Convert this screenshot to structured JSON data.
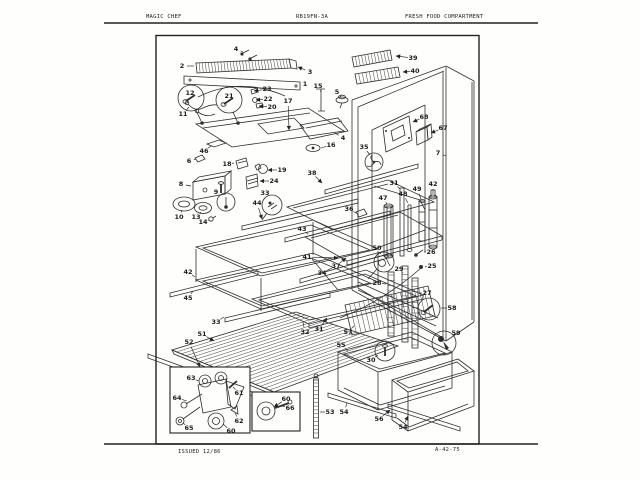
{
  "header": {
    "brand": "MAGIC CHEF",
    "model": "RB19FN-3A",
    "title": "FRESH FOOD COMPARTMENT"
  },
  "footer": {
    "issued": "ISSUED 12/86",
    "page_ref": "A-42-75"
  },
  "diagram": {
    "part_labels": [
      {
        "n": "2",
        "x": 182,
        "y": 66,
        "tx": 194,
        "ty": 66
      },
      {
        "n": "3",
        "x": 310,
        "y": 72,
        "tx": 298,
        "ty": 67
      },
      {
        "n": "1",
        "x": 305,
        "y": 84,
        "tx": 300,
        "ty": 86
      },
      {
        "n": "4",
        "x": 236,
        "y": 49,
        "tx": 243,
        "ty": 52
      },
      {
        "n": "5",
        "x": 337,
        "y": 92,
        "tx": 341,
        "ty": 97
      },
      {
        "n": "15",
        "x": 318,
        "y": 86,
        "tx": 321,
        "ty": 92
      },
      {
        "n": "17",
        "x": 288,
        "y": 101,
        "tx": 289,
        "ty": 130
      },
      {
        "n": "23",
        "x": 267,
        "y": 89,
        "tx": 254,
        "ty": 91
      },
      {
        "n": "22",
        "x": 268,
        "y": 99,
        "tx": 256,
        "ty": 100
      },
      {
        "n": "20",
        "x": 272,
        "y": 107,
        "tx": 259,
        "ty": 106
      },
      {
        "n": "12",
        "x": 190,
        "y": 93
      },
      {
        "n": "21",
        "x": 229,
        "y": 96
      },
      {
        "n": "11",
        "x": 183,
        "y": 114,
        "tx": 189,
        "ty": 107
      },
      {
        "n": "46",
        "x": 204,
        "y": 151,
        "tx": 211,
        "ty": 146
      },
      {
        "n": "6",
        "x": 189,
        "y": 161,
        "tx": 196,
        "ty": 159
      },
      {
        "n": "18",
        "x": 227,
        "y": 164,
        "tx": 234,
        "ty": 163
      },
      {
        "n": "19",
        "x": 282,
        "y": 170,
        "tx": 268,
        "ty": 170
      },
      {
        "n": "24",
        "x": 274,
        "y": 181,
        "tx": 260,
        "ty": 181
      },
      {
        "n": "8",
        "x": 181,
        "y": 184,
        "tx": 191,
        "ty": 186
      },
      {
        "n": "9",
        "x": 216,
        "y": 192,
        "tx": 221,
        "ty": 190
      },
      {
        "n": "33",
        "x": 265,
        "y": 193
      },
      {
        "n": "44",
        "x": 257,
        "y": 203,
        "tx": 262,
        "ty": 219
      },
      {
        "n": "10",
        "x": 179,
        "y": 217,
        "tx": 182,
        "ty": 210
      },
      {
        "n": "13",
        "x": 196,
        "y": 217,
        "tx": 201,
        "ty": 212
      },
      {
        "n": "14",
        "x": 203,
        "y": 222,
        "tx": 209,
        "ty": 220
      },
      {
        "n": "16",
        "x": 331,
        "y": 145,
        "tx": 321,
        "ty": 148
      },
      {
        "n": "4",
        "x": 343,
        "y": 138,
        "tx": 335,
        "ty": 133
      },
      {
        "n": "35",
        "x": 364,
        "y": 147,
        "tx": 370,
        "ty": 155
      },
      {
        "n": "38",
        "x": 312,
        "y": 173,
        "tx": 322,
        "ty": 183
      },
      {
        "n": "34",
        "x": 322,
        "y": 273,
        "tx": 332,
        "ty": 268
      },
      {
        "n": "37",
        "x": 336,
        "y": 266,
        "tx": 346,
        "ty": 258
      },
      {
        "n": "43",
        "x": 302,
        "y": 229,
        "tx": 308,
        "ty": 234
      },
      {
        "n": "41",
        "x": 307,
        "y": 257,
        "tx": 338,
        "ty": 258
      },
      {
        "n": "42",
        "x": 188,
        "y": 272,
        "tx": 195,
        "ty": 277
      },
      {
        "n": "45",
        "x": 188,
        "y": 298,
        "tx": 193,
        "ty": 291
      },
      {
        "n": "33",
        "x": 216,
        "y": 322,
        "tx": 224,
        "ty": 317
      },
      {
        "n": "32",
        "x": 305,
        "y": 332,
        "tx": 303,
        "ty": 322
      },
      {
        "n": "31",
        "x": 319,
        "y": 329,
        "tx": 327,
        "ty": 318
      },
      {
        "n": "51",
        "x": 202,
        "y": 334,
        "tx": 214,
        "ty": 341
      },
      {
        "n": "52",
        "x": 189,
        "y": 342,
        "tx": 200,
        "ty": 367
      },
      {
        "n": "53",
        "x": 330,
        "y": 412,
        "tx": 320,
        "ty": 412
      },
      {
        "n": "39",
        "x": 413,
        "y": 58,
        "tx": 396,
        "ty": 56
      },
      {
        "n": "40",
        "x": 415,
        "y": 71,
        "tx": 403,
        "ty": 72
      },
      {
        "n": "68",
        "x": 424,
        "y": 117,
        "tx": 413,
        "ty": 122
      },
      {
        "n": "67",
        "x": 443,
        "y": 128,
        "tx": 431,
        "ty": 133
      },
      {
        "n": "7",
        "x": 438,
        "y": 153,
        "tx": 446,
        "ty": 156
      },
      {
        "n": "31",
        "x": 394,
        "y": 183,
        "tx": 400,
        "ty": 189
      },
      {
        "n": "47",
        "x": 383,
        "y": 198,
        "tx": 387,
        "ty": 204
      },
      {
        "n": "48",
        "x": 403,
        "y": 194,
        "tx": 408,
        "ty": 203
      },
      {
        "n": "49",
        "x": 417,
        "y": 189,
        "tx": 421,
        "ty": 199
      },
      {
        "n": "42",
        "x": 433,
        "y": 184,
        "tx": 433,
        "ty": 194
      },
      {
        "n": "36",
        "x": 349,
        "y": 209,
        "tx": 356,
        "ty": 213
      },
      {
        "n": "26",
        "x": 431,
        "y": 252,
        "tx": 424,
        "ty": 252
      },
      {
        "n": "25",
        "x": 432,
        "y": 266,
        "tx": 425,
        "ty": 267
      },
      {
        "n": "50",
        "x": 377,
        "y": 248,
        "tx": 381,
        "ty": 254
      },
      {
        "n": "29",
        "x": 399,
        "y": 269,
        "tx": 403,
        "ty": 273
      },
      {
        "n": "28",
        "x": 377,
        "y": 283,
        "tx": 386,
        "ty": 284
      },
      {
        "n": "27",
        "x": 427,
        "y": 293,
        "tx": 419,
        "ty": 293
      },
      {
        "n": "58",
        "x": 452,
        "y": 308,
        "tx": 441,
        "ty": 308
      },
      {
        "n": "59",
        "x": 456,
        "y": 333
      },
      {
        "n": "57",
        "x": 348,
        "y": 332,
        "tx": 354,
        "ty": 326
      },
      {
        "n": "55",
        "x": 341,
        "y": 345,
        "tx": 348,
        "ty": 351
      },
      {
        "n": "30",
        "x": 371,
        "y": 360,
        "tx": 378,
        "ty": 355
      },
      {
        "n": "54",
        "x": 344,
        "y": 412,
        "tx": 347,
        "ty": 403
      },
      {
        "n": "56",
        "x": 379,
        "y": 419,
        "tx": 390,
        "ty": 410
      },
      {
        "n": "54",
        "x": 403,
        "y": 427,
        "tx": 408,
        "ty": 416
      },
      {
        "n": "63",
        "x": 191,
        "y": 378,
        "tx": 199,
        "ty": 381
      },
      {
        "n": "61",
        "x": 239,
        "y": 393,
        "tx": 233,
        "ty": 387
      },
      {
        "n": "64",
        "x": 177,
        "y": 398,
        "tx": 187,
        "ty": 401
      },
      {
        "n": "65",
        "x": 189,
        "y": 428,
        "tx": 183,
        "ty": 423
      },
      {
        "n": "62",
        "x": 239,
        "y": 421,
        "tx": 235,
        "ty": 413
      },
      {
        "n": "60",
        "x": 231,
        "y": 431,
        "tx": 223,
        "ty": 424
      },
      {
        "n": "60",
        "x": 286,
        "y": 399,
        "tx": 274,
        "ty": 407
      },
      {
        "n": "66",
        "x": 290,
        "y": 408,
        "tx": 282,
        "ty": 406
      }
    ]
  }
}
